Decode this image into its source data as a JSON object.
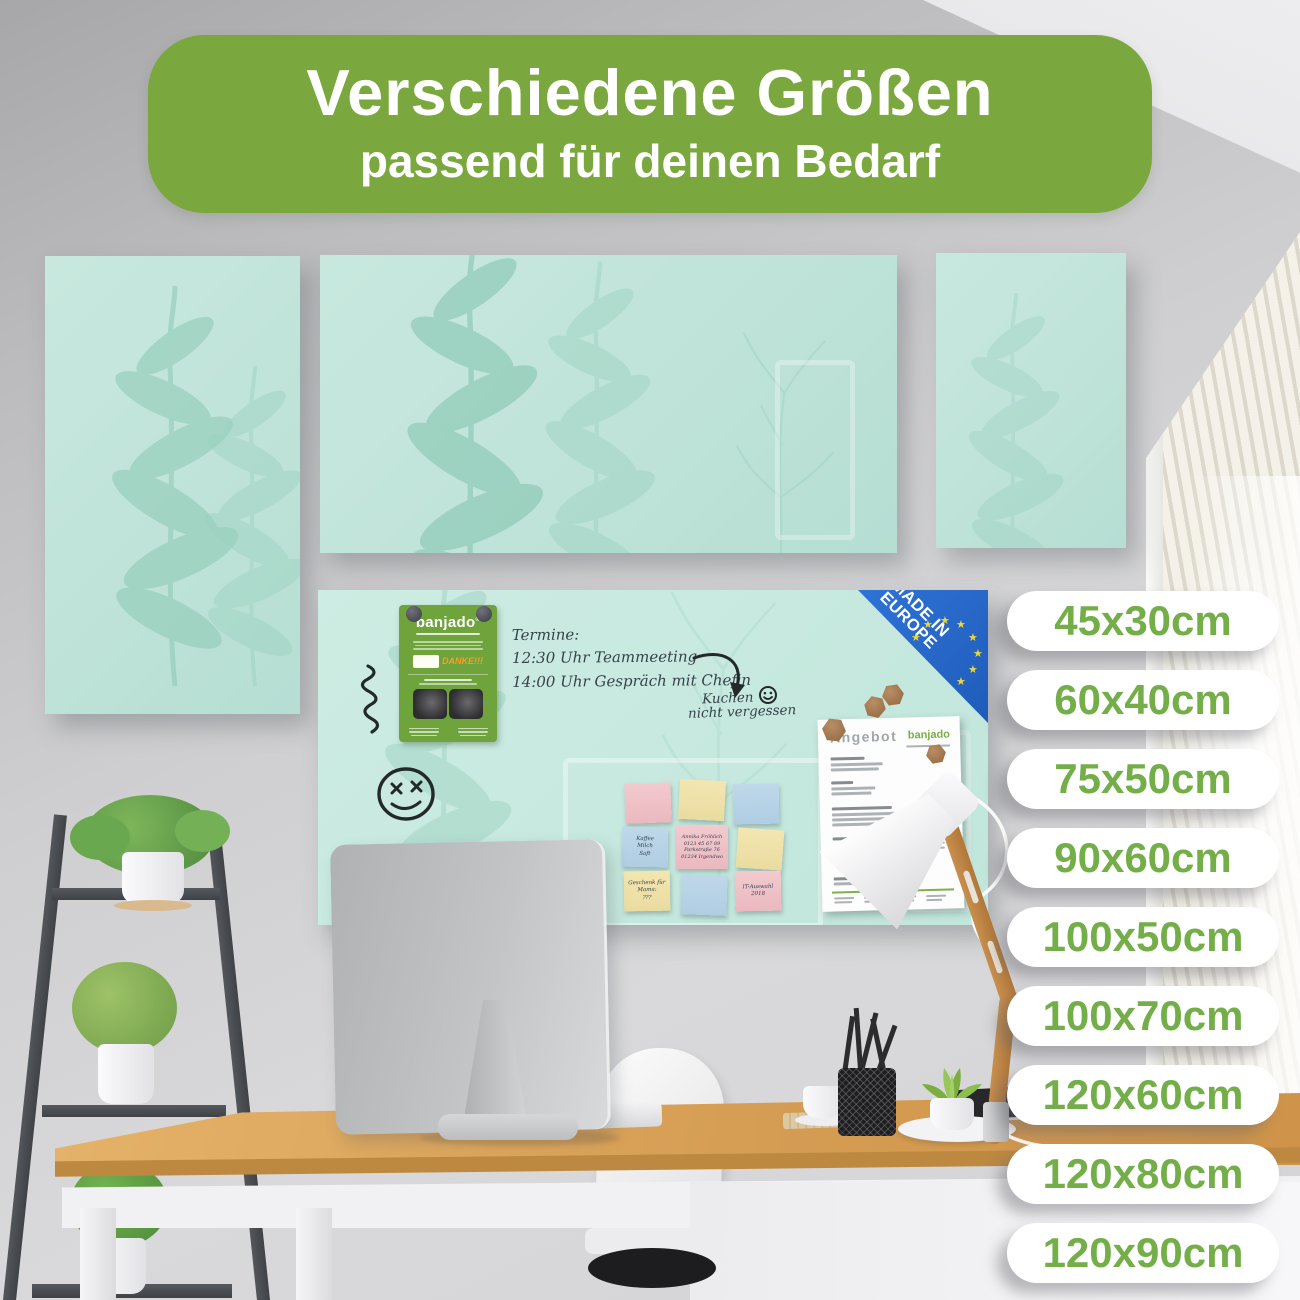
{
  "banner": {
    "title": "Verschiedene Größen",
    "subtitle": "passend für deinen Bedarf"
  },
  "size_labels": [
    "45x30cm",
    "60x40cm",
    "75x50cm",
    "90x60cm",
    "100x50cm",
    "100x70cm",
    "120x60cm",
    "120x80cm",
    "120x90cm"
  ],
  "badge": {
    "line1": "MADE IN",
    "line2": "EUROPE"
  },
  "board_notes": {
    "heading": "Termine:",
    "appointment1": "12:30 Uhr Teammeeting",
    "appointment2": "14:00 Uhr Gespräch mit Chefin",
    "reminder1": "Kuchen",
    "reminder2": "nicht vergessen"
  },
  "sticky_notes": {
    "shopping": "Kaffee\nMilch\nSaft",
    "contact": "Annika Fröhlich\n0123 45 67 89\nParkstraße 76\n01234 Irgendwo",
    "gift": "Geschenk für\nMama:\n???",
    "auswahl": "IT-Auswahl\n2018"
  },
  "leaflet": {
    "brand": "banjado",
    "reg": "®",
    "thanks": "DANKE!!!"
  },
  "document": {
    "title": "Angebot",
    "brand": "banjado"
  },
  "colors": {
    "accent_green": "#7aa83e",
    "pill_text_green": "#74ae49",
    "board_mint": "#c2e5db",
    "badge_blue": "#2566cc",
    "star_yellow": "#ecd63c"
  }
}
